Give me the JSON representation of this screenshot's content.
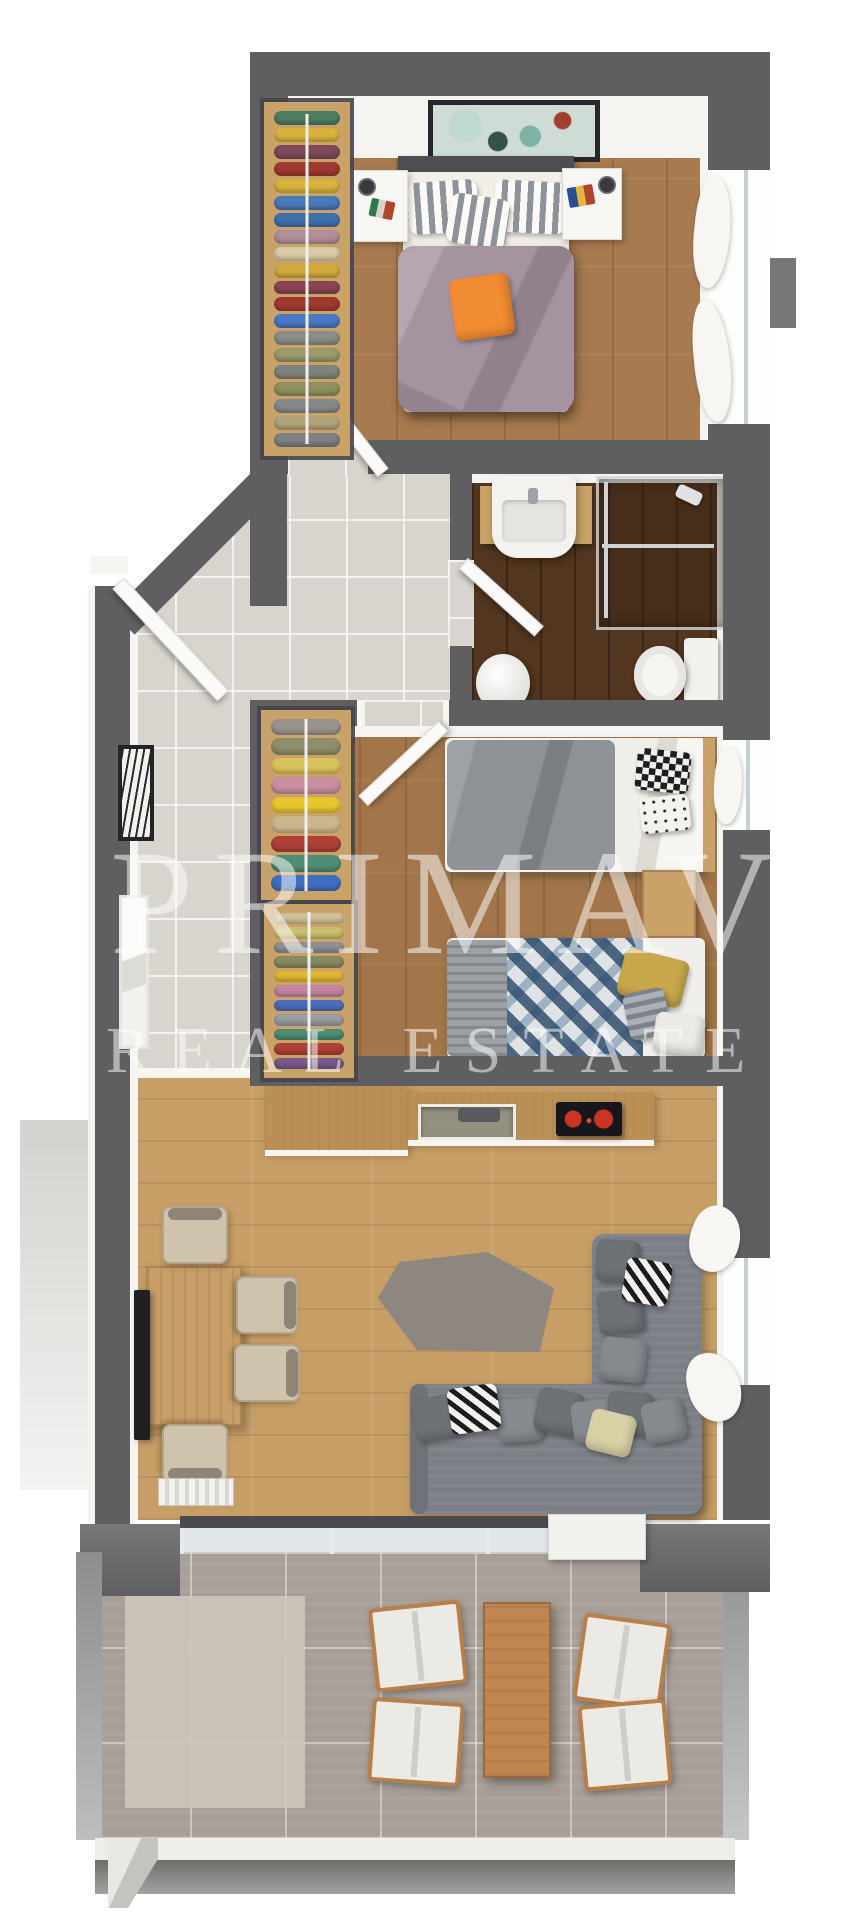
{
  "watermark": {
    "line1": "PRIMAVERA",
    "line2": "REAL ESTATE"
  },
  "palette": {
    "wall": "#5f5f62",
    "wallLight": "#77777a",
    "face": "#f5f4f1",
    "bedroomFloor": "#a87a4f",
    "bathFloor": "#53361f",
    "kidsFloor": "#a2754a",
    "livingFloor": "#c79e66",
    "hallTile": "#d8d4ce",
    "terrace": "#a79e97",
    "rug": "#cdc5bd",
    "counter": "#bb9057",
    "woodWardrobe": "#c9a26a",
    "table": "#c89f68",
    "chairBeige": "#cfc3ad",
    "sofa": "#7c8086",
    "duvet": "#a5939f",
    "orange": "#f28c33",
    "mattress": "#f2efe8",
    "kidsDuvet": "#8e9296",
    "knit": "#9aa0a4",
    "yellowPillow": "#c9a84c",
    "terraceWoodChair": "#b97f4a",
    "terraceTable": "#c08552",
    "glass": "#c6d0d4",
    "headboard": "#4e4e52",
    "tv": "#202024",
    "cooktop": "#16161c",
    "burner": "#cc3524"
  },
  "master_bedroom": {
    "wardrobe_clothes": [
      "#4e7d62",
      "#d9b33c",
      "#7e4a5a",
      "#a03a30",
      "#d9b33c",
      "#4a79b8",
      "#3f6fae",
      "#b08f98",
      "#d8cba8",
      "#d2a93c",
      "#8a4452",
      "#a03a30",
      "#4a79c4",
      "#8a8d88",
      "#9a9a6a",
      "#7f837e",
      "#8f8f5f",
      "#86898a",
      "#b3a27a",
      "#7d8183"
    ]
  },
  "kids_bedroom": {
    "wardrobe_upper": [
      "#9a938b",
      "#8e8e6a",
      "#d9c25a",
      "#c78fa0",
      "#e6c52e",
      "#cbb68e",
      "#b04038",
      "#4e8d77",
      "#3f6fc0"
    ],
    "wardrobe_lower": [
      "#cfc098",
      "#c9c06e",
      "#8d9094",
      "#8a8a62",
      "#e0b832",
      "#c585a2",
      "#4a6fbe",
      "#9a9da0",
      "#4e8d77",
      "#b04038",
      "#7a5a8a"
    ]
  },
  "living_room": {
    "sofa_pillows": [
      {
        "x": 414,
        "y": 1396,
        "w": 46,
        "h": 44,
        "r": -10,
        "c": "#6e7277"
      },
      {
        "x": 497,
        "y": 1398,
        "w": 46,
        "h": 44,
        "r": -5,
        "c": "#858a8f"
      },
      {
        "x": 536,
        "y": 1390,
        "w": 46,
        "h": 44,
        "r": 12,
        "c": "#6e7277"
      },
      {
        "x": 572,
        "y": 1400,
        "w": 44,
        "h": 42,
        "r": -7,
        "c": "#858a8f"
      },
      {
        "x": 607,
        "y": 1392,
        "w": 46,
        "h": 44,
        "r": 5,
        "c": "#6e7277"
      },
      {
        "x": 643,
        "y": 1400,
        "w": 42,
        "h": 42,
        "r": -12,
        "c": "#858a8f"
      },
      {
        "x": 598,
        "y": 1290,
        "w": 46,
        "h": 44,
        "r": -6,
        "c": "#6e7277"
      },
      {
        "x": 600,
        "y": 1338,
        "w": 46,
        "h": 44,
        "r": 7,
        "c": "#858a8f"
      },
      {
        "x": 596,
        "y": 1240,
        "w": 44,
        "h": 42,
        "r": 4,
        "c": "#6e7277"
      }
    ]
  }
}
